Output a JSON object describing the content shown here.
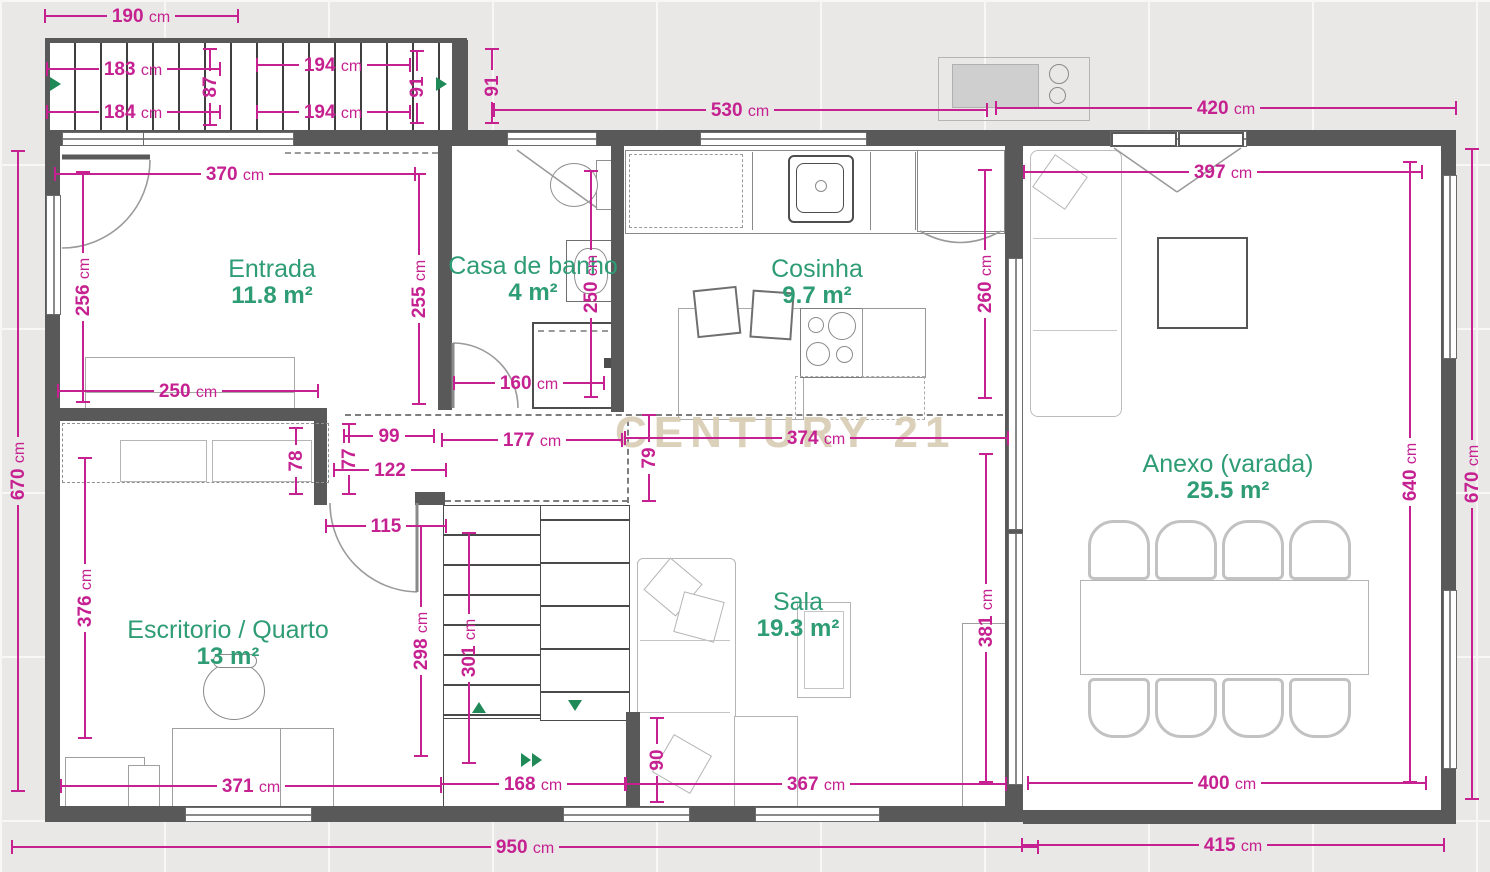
{
  "watermark": {
    "text": "CENTURY 21",
    "color": "#d9cdb4"
  },
  "colors": {
    "dimension": "#c52191",
    "room_label": "#2e9c74",
    "wall": "#59595a"
  },
  "rooms": [
    {
      "id": "entrada",
      "name": "Entrada",
      "area": "11.8 m²"
    },
    {
      "id": "banho",
      "name": "Casa de banho",
      "area": "4 m²"
    },
    {
      "id": "cosinha",
      "name": "Cosinha",
      "area": "9.7 m²"
    },
    {
      "id": "sala",
      "name": "Sala",
      "area": "19.3 m²"
    },
    {
      "id": "escritorio",
      "name": "Escritorio / Quarto",
      "area": "13 m²"
    },
    {
      "id": "anexo",
      "name": "Anexo (varada)",
      "area": "25.5 m²"
    }
  ],
  "dimensions": [
    {
      "t": "190 cm",
      "x": 141,
      "y": 16,
      "l": 195
    },
    {
      "t": "183 cm",
      "x": 133,
      "y": 69,
      "l": 175
    },
    {
      "t": "184 cm",
      "x": 133,
      "y": 112,
      "l": 175
    },
    {
      "t": "87",
      "x": 210,
      "y": 87,
      "l": 78,
      "v": 1
    },
    {
      "t": "194 cm",
      "x": 333,
      "y": 65,
      "l": 155
    },
    {
      "t": "194 cm",
      "x": 333,
      "y": 112,
      "l": 155
    },
    {
      "t": "91",
      "x": 417,
      "y": 87,
      "l": 74,
      "v": 1
    },
    {
      "t": "91",
      "x": 492,
      "y": 86,
      "l": 76,
      "v": 1
    },
    {
      "t": "530 cm",
      "x": 740,
      "y": 110,
      "l": 495
    },
    {
      "t": "420 cm",
      "x": 1226,
      "y": 108,
      "l": 462
    },
    {
      "t": "370 cm",
      "x": 235,
      "y": 174,
      "l": 362
    },
    {
      "t": "256 cm",
      "x": 83,
      "y": 287,
      "l": 232,
      "v": 1
    },
    {
      "t": "255 cm",
      "x": 419,
      "y": 289,
      "l": 232,
      "v": 1
    },
    {
      "t": "250 cm",
      "x": 188,
      "y": 391,
      "l": 262
    },
    {
      "t": "250 cm",
      "x": 591,
      "y": 284,
      "l": 228,
      "v": 1
    },
    {
      "t": "160 cm",
      "x": 529,
      "y": 383,
      "l": 152
    },
    {
      "t": "260 cm",
      "x": 985,
      "y": 284,
      "l": 230,
      "v": 1
    },
    {
      "t": "374 cm",
      "x": 816,
      "y": 438,
      "l": 385
    },
    {
      "t": "99",
      "x": 389,
      "y": 436,
      "l": 92
    },
    {
      "t": "177 cm",
      "x": 532,
      "y": 440,
      "l": 182
    },
    {
      "t": "79",
      "x": 649,
      "y": 458,
      "l": 88,
      "v": 1
    },
    {
      "t": "77",
      "x": 349,
      "y": 459,
      "l": 72,
      "v": 1
    },
    {
      "t": "122",
      "x": 390,
      "y": 470,
      "l": 114
    },
    {
      "t": "115",
      "x": 386,
      "y": 526,
      "l": 122
    },
    {
      "t": "78",
      "x": 296,
      "y": 461,
      "l": 68,
      "v": 1
    },
    {
      "t": "670 cm",
      "x": 18,
      "y": 471,
      "l": 642,
      "v": 1
    },
    {
      "t": "376 cm",
      "x": 85,
      "y": 598,
      "l": 282,
      "v": 1
    },
    {
      "t": "298 cm",
      "x": 421,
      "y": 641,
      "l": 232,
      "v": 1
    },
    {
      "t": "301 cm",
      "x": 469,
      "y": 648,
      "l": 232,
      "v": 1
    },
    {
      "t": "371 cm",
      "x": 251,
      "y": 786,
      "l": 382
    },
    {
      "t": "168 cm",
      "x": 533,
      "y": 784,
      "l": 186
    },
    {
      "t": "90",
      "x": 657,
      "y": 760,
      "l": 86,
      "v": 1
    },
    {
      "t": "367 cm",
      "x": 816,
      "y": 784,
      "l": 382
    },
    {
      "t": "381 cm",
      "x": 986,
      "y": 618,
      "l": 330,
      "v": 1
    },
    {
      "t": "397 cm",
      "x": 1223,
      "y": 172,
      "l": 400
    },
    {
      "t": "640 cm",
      "x": 1410,
      "y": 472,
      "l": 622,
      "v": 1
    },
    {
      "t": "670 cm",
      "x": 1472,
      "y": 474,
      "l": 652,
      "v": 1
    },
    {
      "t": "400 cm",
      "x": 1227,
      "y": 783,
      "l": 400
    },
    {
      "t": "415 cm",
      "x": 1233,
      "y": 845,
      "l": 424
    },
    {
      "t": "950 cm",
      "x": 525,
      "y": 847,
      "l": 1028
    }
  ]
}
